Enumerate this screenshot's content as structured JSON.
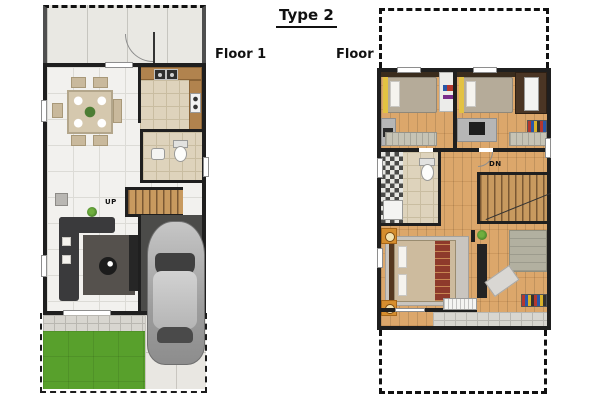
{
  "title": "Type 2",
  "floor1": {
    "label": "Floor 1",
    "stairs_label": "UP"
  },
  "floor2": {
    "label": "Floor 2",
    "stairs_label": "DN"
  },
  "colors": {
    "wall": "#1f1f1f",
    "wood_floor": "#dca76b",
    "white_tile": "#f2f1ee",
    "beige_tile": "#ded3bc",
    "lawn": "#58a02c",
    "kitchen_counter": "#b1834e",
    "car": "#a8a8a8",
    "sofa": "#3a3a3c",
    "bed_runner": "#8e3a2b",
    "nightstand": "#d68e2e"
  }
}
